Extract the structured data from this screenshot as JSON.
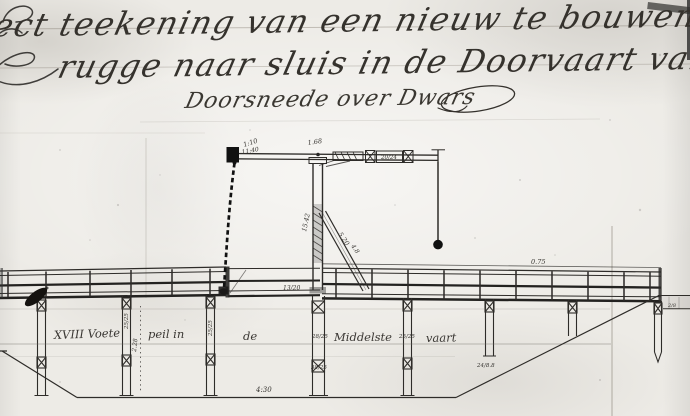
{
  "document": {
    "title_line1": "ject teekening van een nieuw te bouwen opha",
    "title_line2": "rugge naar sluis in de Doorvaart van de",
    "section_title": "Doorsneede over Dwars"
  },
  "drawing": {
    "water_label": {
      "part1": "XVIII Voete",
      "part2": "peil in",
      "part3": "de",
      "part4": "Middelste",
      "part5": "vaart"
    },
    "dimensions": {
      "beam_left_a": "1:10",
      "beam_left_b": "11:40",
      "beam_mid": "1.68",
      "beam_right": "20/24",
      "span": "0.75",
      "deck_gap": "13/20",
      "post_height": "15.42",
      "brace_a": "5.20",
      "brace_b": "4.8",
      "depth": "2.28",
      "bottom_width": "4:30",
      "pile2": "25/25",
      "pile3": "25/25",
      "pile4_upper": "28/25",
      "pile4_lower": "38/25",
      "pile5": "25/25",
      "pile6": "24/8.8",
      "pile8": "2/8"
    }
  }
}
